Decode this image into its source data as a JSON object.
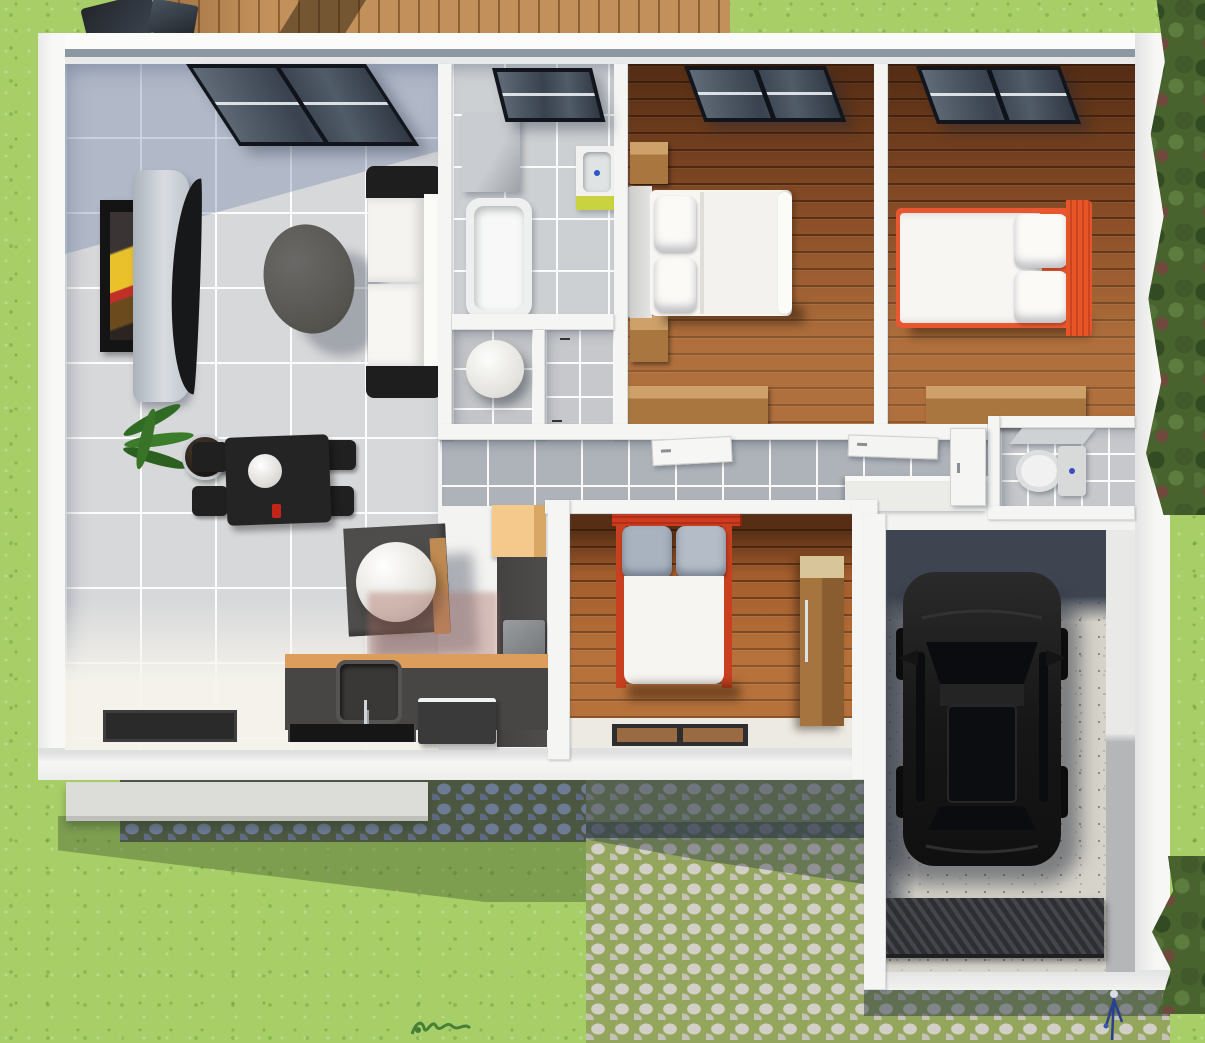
{
  "scene": {
    "title": "3D rendered top-down floor plan of a single-storey house with garage",
    "view": "top-down 3D architectural render",
    "visible_text": "none"
  },
  "palette": {
    "grass": "#a8cf67",
    "hedge": "#49632f",
    "deck_wood": "#c2905a",
    "wall_white": "#f5f5f3",
    "parapet_gray": "#8c97a1",
    "tile_floor": "#d7d8da",
    "hall_tile": "#b0b4ba",
    "wood_floor": "#8d5028",
    "bed_linen": "#f7f6f3",
    "accent_orange": "#e8572f",
    "headboard_red": "#c93a20",
    "counter_dark": "#474645",
    "counter_wood": "#dd9e5b",
    "sink_cabinet_lime": "#c9d23f",
    "garage_floor": "#d6d3ca",
    "car_black": "#1a1a1a",
    "cobble_stone": "#d2cfc7",
    "cobble_moss": "#94a65e",
    "shadow_blue": "#3e4551"
  },
  "exterior": {
    "lawn": "grass lawn",
    "deck": "wooden deck",
    "patio_furniture": "dark patio furniture",
    "hedge_right": "hedge and shrubs",
    "hedge_corner": "corner shrubs",
    "walkway": "shaded cobblestone walkway",
    "driveway": "cobblestone driveway",
    "step": "entry step",
    "watermark": "artist watermark squiggle",
    "flower": "small blue flower"
  },
  "rooms": {
    "living": {
      "name": "Living room and kitchen",
      "furniture": [
        "wall TV with artwork",
        "curved TV stand",
        "oval coffee table",
        "white sofa with dark armrests",
        "potted plant",
        "dining table with four chairs",
        "side table with white sphere",
        "tan cabinet",
        "kitchen counter with sink",
        "cooktop",
        "dishwasher",
        "door mat"
      ]
    },
    "bathroom": {
      "name": "Bathroom",
      "furniture": [
        "skylight window",
        "storage block",
        "bathtub",
        "wash basin with lime cabinet"
      ]
    },
    "utility": {
      "name": "Utility closet",
      "furniture": [
        "water heater cylinder"
      ]
    },
    "shower": {
      "name": "Shower closet"
    },
    "hallway": {
      "name": "Hallway",
      "furniture": [
        "open door panels",
        "console ledge"
      ]
    },
    "bedroom1": {
      "name": "Bedroom 1",
      "furniture": [
        "window",
        "double bed",
        "two nightstands",
        "dresser"
      ]
    },
    "bedroom2": {
      "name": "Bedroom 2",
      "furniture": [
        "window",
        "double bed with orange frame",
        "dresser"
      ]
    },
    "bedroom3": {
      "name": "Bedroom 3",
      "furniture": [
        "double bed with red headboard",
        "wardrobe",
        "door mat"
      ]
    },
    "wc": {
      "name": "WC",
      "furniture": [
        "toilet",
        "corner shelf"
      ]
    },
    "garage": {
      "name": "Garage",
      "furniture": [
        "black car",
        "ribbed floor grate"
      ]
    }
  }
}
